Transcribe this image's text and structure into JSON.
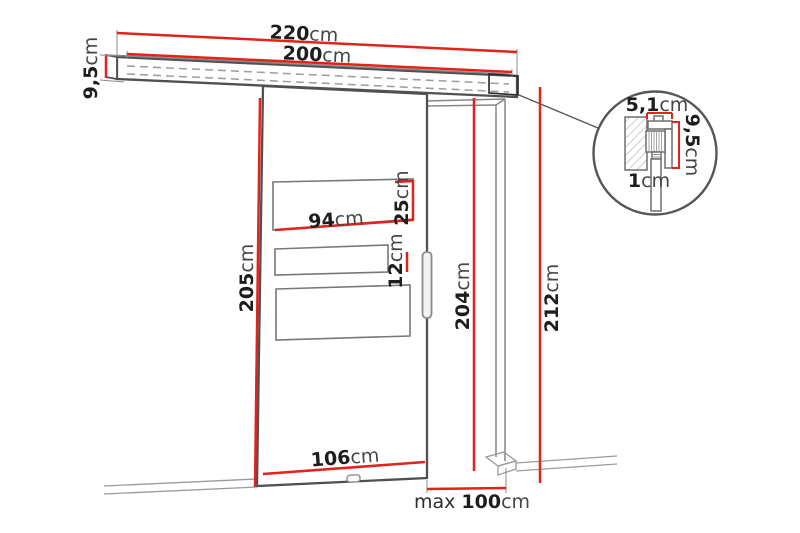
{
  "diagram_title": "Sliding door technical dimension drawing",
  "colors": {
    "dimension_red": "#e2231a",
    "outline_gray": "#4f5052",
    "text_black": "#1d1d1b"
  },
  "labels": {
    "rail_total_width": {
      "value": "220",
      "unit": "cm"
    },
    "rail_inner_width": {
      "value": "200",
      "unit": "cm"
    },
    "rail_height": {
      "value": "9,5",
      "unit": "cm"
    },
    "door_height": {
      "value": "205",
      "unit": "cm"
    },
    "door_width": {
      "value": "106",
      "unit": "cm"
    },
    "glass_panel_width": {
      "value": "94",
      "unit": "cm"
    },
    "glass_top_height": {
      "value": "25",
      "unit": "cm"
    },
    "glass_mid_height": {
      "value": "12",
      "unit": "cm"
    },
    "opening_height": {
      "value": "204",
      "unit": "cm"
    },
    "total_height": {
      "value": "212",
      "unit": "cm"
    },
    "max_opening_width": {
      "prefix": "max ",
      "value": "100",
      "unit": "cm"
    },
    "detail_width": {
      "value": "5,1",
      "unit": "cm"
    },
    "detail_height": {
      "value": "9,5",
      "unit": "cm"
    },
    "detail_thickness": {
      "value": "1",
      "unit": "cm"
    }
  }
}
